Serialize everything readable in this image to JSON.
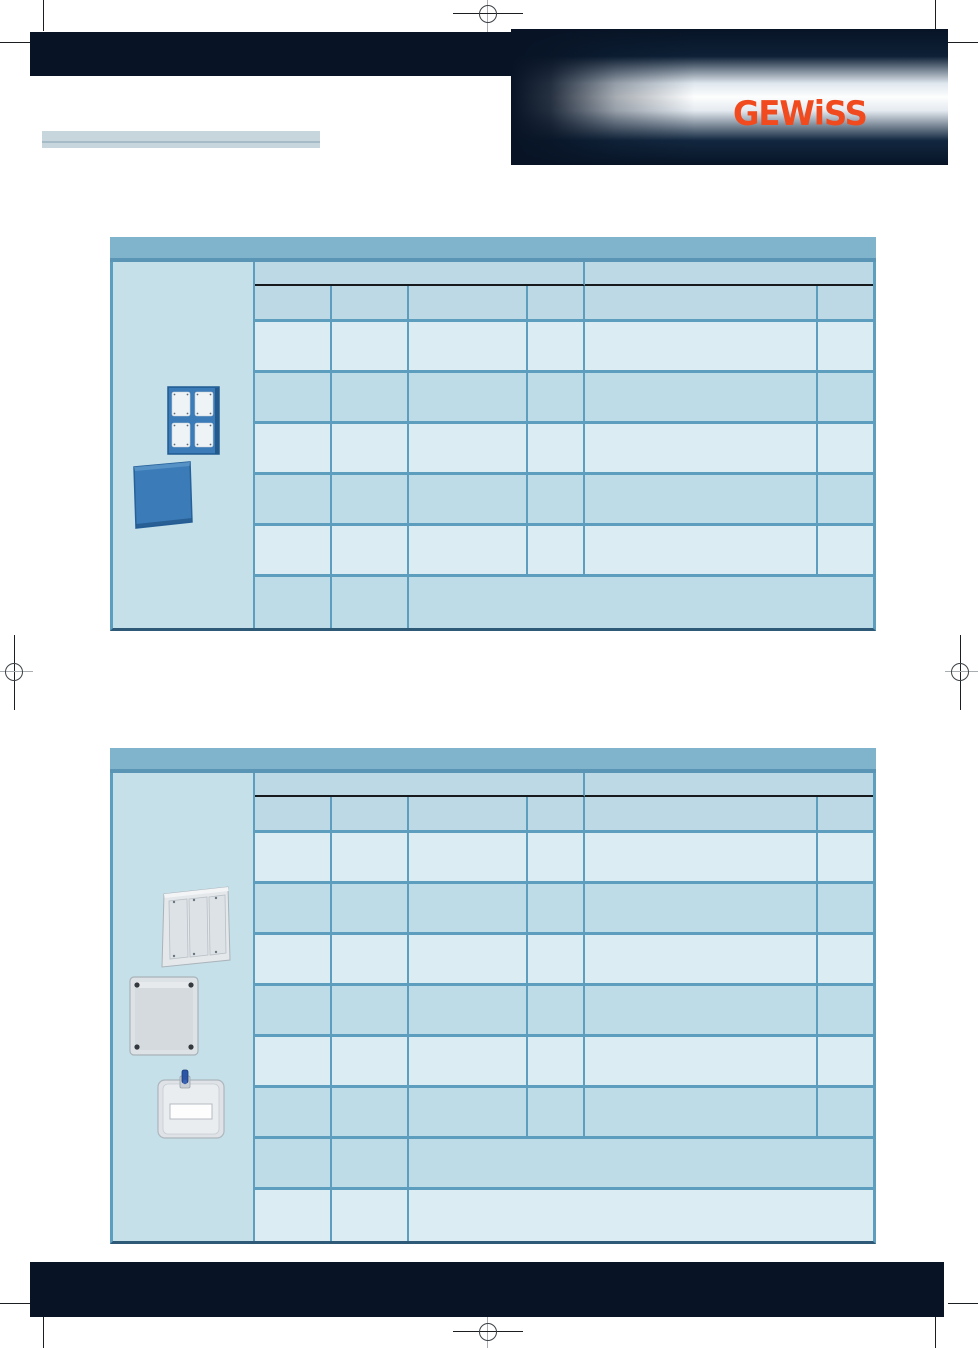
{
  "brand": {
    "logo_text": "GEWiSS",
    "logo_color": "#F04A1E"
  },
  "header": {
    "title_bar_text": ""
  },
  "tables": [
    {
      "id": "product-table-1",
      "header_band_text": "",
      "column_groups": [
        "",
        ""
      ],
      "columns": [
        "",
        "",
        "",
        "",
        "",
        ""
      ],
      "data_row_count": 6,
      "merged_tail_row_count": 1,
      "product_images": [
        "flanged-panel-4-openings",
        "blind-lid"
      ]
    },
    {
      "id": "product-table-2",
      "header_band_text": "",
      "column_groups": [
        "",
        ""
      ],
      "columns": [
        "",
        "",
        "",
        "",
        "",
        ""
      ],
      "data_row_count": 8,
      "merged_tail_row_count": 2,
      "product_images": [
        "modular-panel-3-doors",
        "enclosure-box",
        "flanged-window-panel"
      ]
    }
  ],
  "colors": {
    "page_navy": "#081426",
    "logo_orange": "#F04A1E",
    "table_header_band": "#7FB4CC",
    "group_row_bg": "#BCD9E5",
    "row_light": "#DCECF3",
    "row_medium": "#BEDCE8",
    "image_column_bg": "#C5E0E9",
    "grid_border": "#5D9DBD",
    "table_bottom_border": "#2E5A78",
    "title_bar_bg": "#C7D6DC",
    "title_bar_line": "#A5BCC6"
  }
}
